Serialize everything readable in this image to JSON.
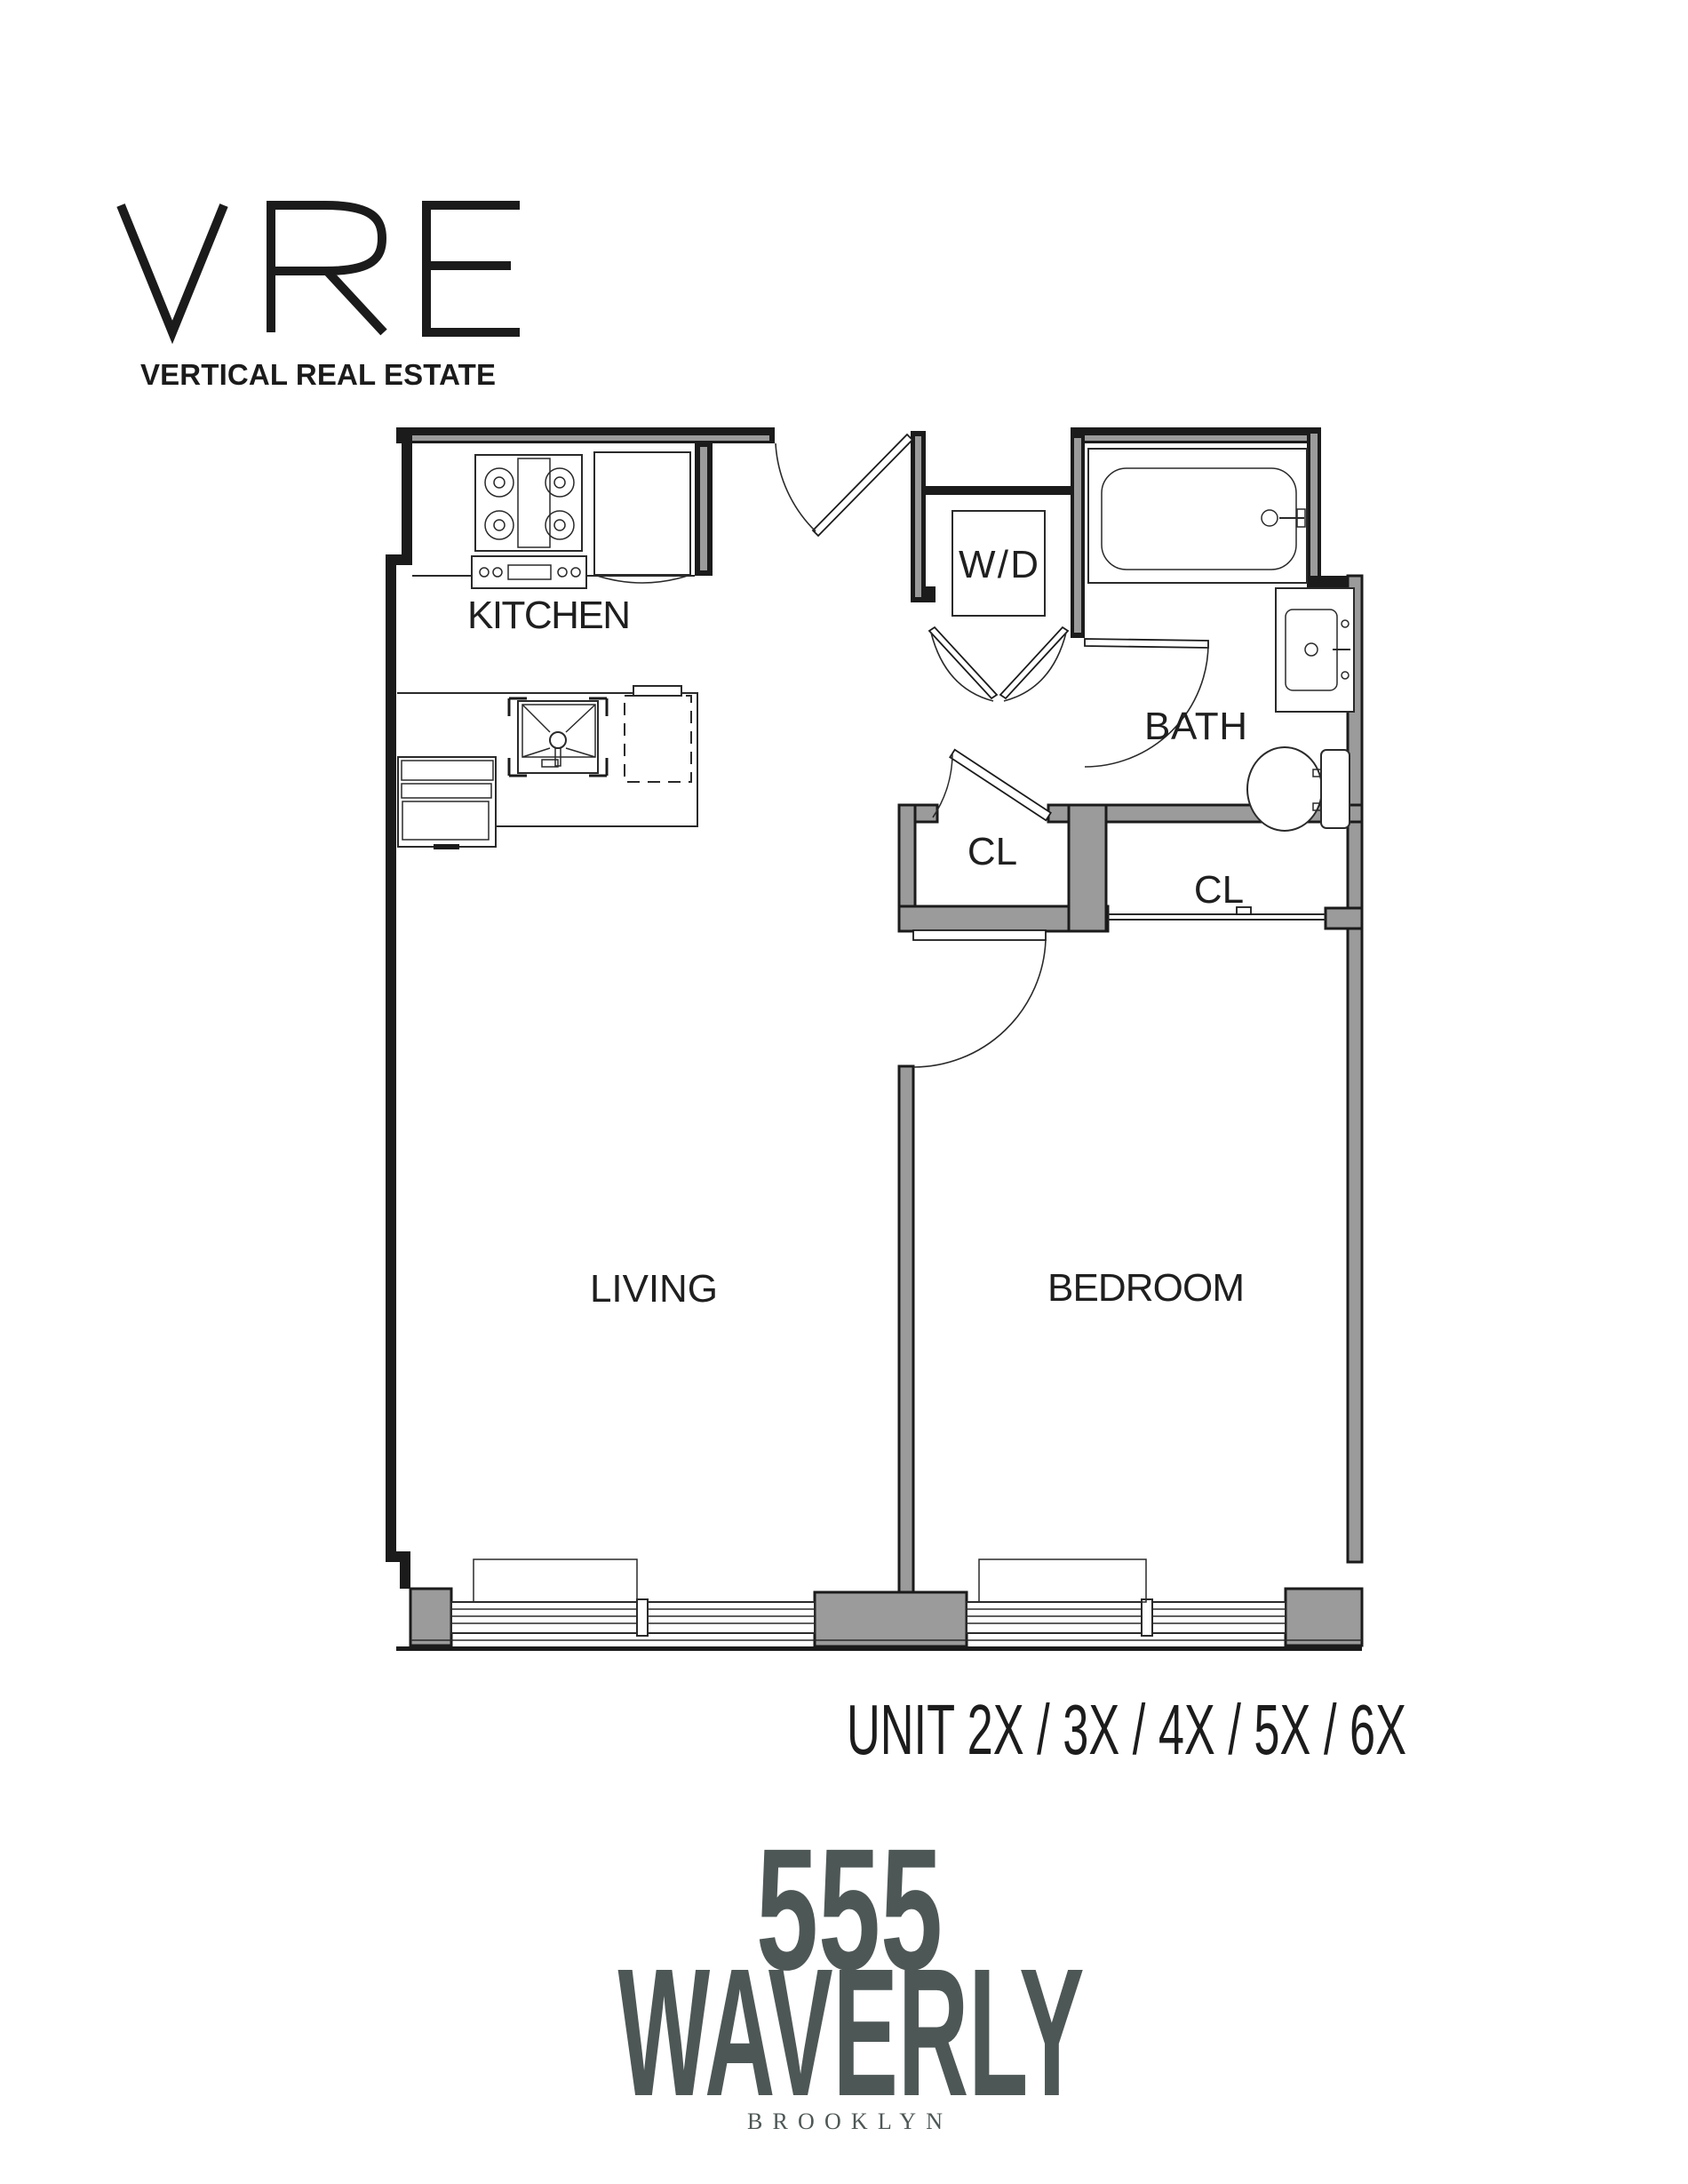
{
  "brand": {
    "logo": "VRE",
    "tagline": "VERTICAL REAL ESTATE"
  },
  "floorplan": {
    "labels": {
      "kitchen": "KITCHEN",
      "washer_dryer": "W/D",
      "bath": "BATH",
      "closet_hall": "CL",
      "closet_bedroom": "CL",
      "living": "LIVING",
      "bedroom": "BEDROOM"
    }
  },
  "unit": {
    "line": "UNIT 2X / 3X / 4X / 5X / 6X"
  },
  "building": {
    "number": "555",
    "name": "WAVERLY",
    "borough": "BROOKLYN"
  },
  "colors": {
    "logo_accent": "#4d5756",
    "wall_gray": "#9b9b9b",
    "line_black": "#1b1b1b"
  }
}
